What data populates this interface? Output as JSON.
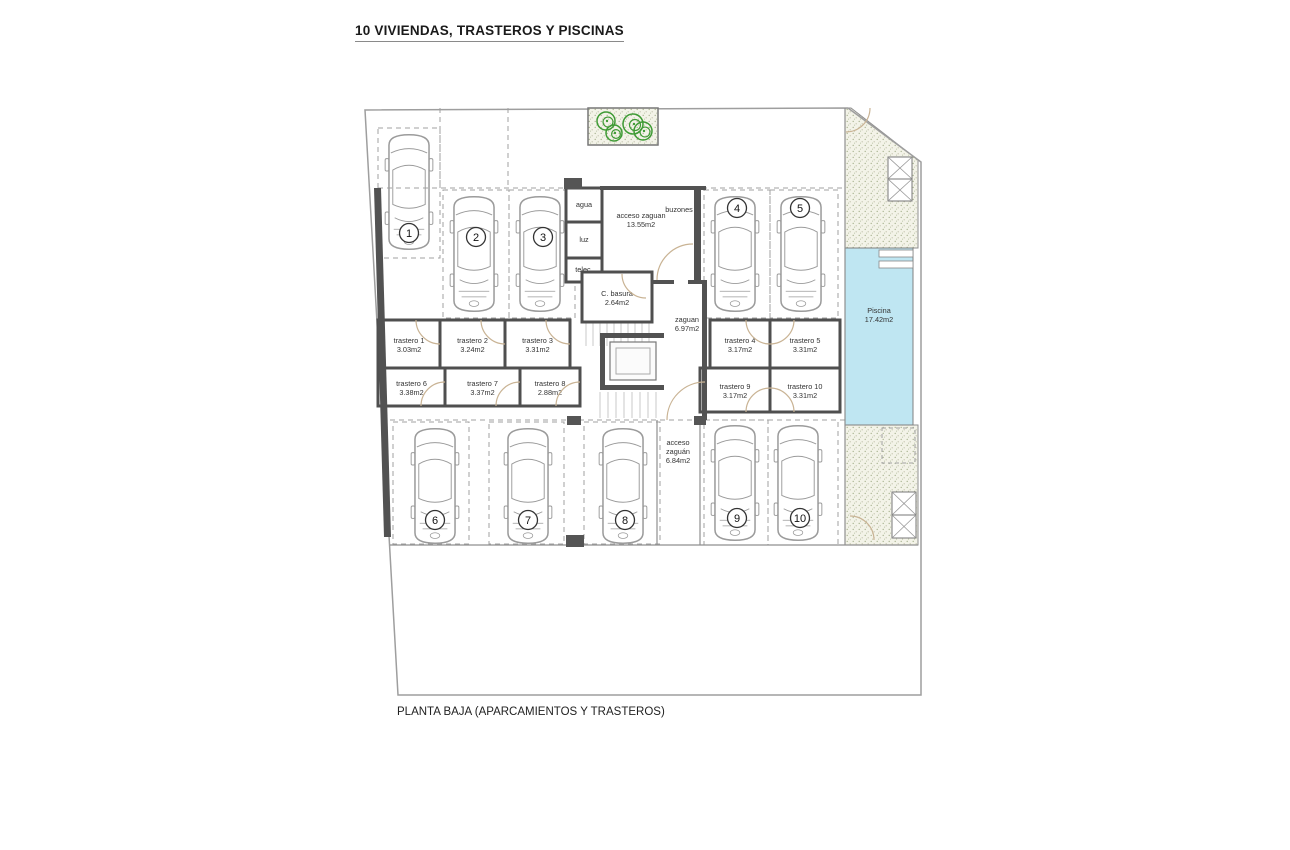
{
  "title": "10 VIVIENDAS, TRASTEROS Y PISCINAS",
  "caption": "PLANTA BAJA (APARCAMIENTOS Y TRASTEROS)",
  "colors": {
    "wall": "#525252",
    "room_stroke": "#4f4f4f",
    "thin": "#8f8f8f",
    "dash": "#a0a0a0",
    "pool": "#bfe6f2",
    "pool_stroke": "#808080",
    "stipple_bg": "#f3f3e8",
    "stipple_dot": "#a9b391",
    "tree": "#3f9b35",
    "door": "#c9b394",
    "car": "#9b9b9b",
    "stairs": "#c9c9c9",
    "boundary": "#9e9e9e"
  },
  "plan": {
    "plot_outline": "365,110 848,108 921,162 921,695 398,695",
    "stipple_upper": "845,108 851,108 918,160 918,248 845,248",
    "stipple_lower": [
      845,
      425,
      73,
      120
    ],
    "pool": {
      "x": 845,
      "y": 248,
      "w": 68,
      "h": 177,
      "label": "Piscina",
      "area": "17.42m2",
      "lx": 879,
      "ly": 313,
      "steps": [
        [
          879,
          250,
          34,
          7
        ],
        [
          879,
          261,
          34,
          7
        ]
      ]
    },
    "x_boxes": [
      [
        888,
        157,
        24,
        22
      ],
      [
        888,
        179,
        24,
        22
      ],
      [
        892,
        492,
        24,
        23
      ],
      [
        892,
        515,
        24,
        23
      ]
    ],
    "dashed_square": [
      882,
      428,
      33,
      35
    ],
    "left_wall": "374,188 381,188 391,537 384,537",
    "walls": [
      [
        600,
        186,
        106,
        4
      ],
      [
        694,
        190,
        7,
        90
      ],
      [
        702,
        282,
        5,
        138
      ],
      [
        652,
        280,
        22,
        4
      ],
      [
        688,
        280,
        19,
        4
      ]
    ],
    "thin_lines": [
      [
        845,
        108,
        845,
        545
      ],
      [
        390,
        545,
        918,
        545
      ],
      [
        657,
        420,
        657,
        545
      ],
      [
        700,
        420,
        700,
        545
      ]
    ],
    "dashed_lines": [
      [
        378,
        188,
        845,
        188
      ],
      [
        390,
        420,
        845,
        420
      ],
      [
        440,
        108,
        440,
        188
      ],
      [
        508,
        108,
        508,
        188
      ]
    ],
    "rooms": [
      {
        "name": "cuarto-agua",
        "label": "agua",
        "area": "",
        "x": 566,
        "y": 188,
        "w": 36,
        "h": 34
      },
      {
        "name": "cuarto-luz",
        "label": "luz",
        "area": "",
        "x": 566,
        "y": 222,
        "w": 36,
        "h": 36
      },
      {
        "name": "cuarto-telec",
        "label": "telec.",
        "area": "",
        "x": 566,
        "y": 258,
        "w": 36,
        "h": 24
      },
      {
        "name": "cuarto-basura",
        "label": "C. basura",
        "area": "2.64m2",
        "x": 582,
        "y": 272,
        "w": 70,
        "h": 50
      },
      {
        "name": "trastero-1",
        "label": "trastero 1",
        "area": "3.03m2",
        "x": 378,
        "y": 320,
        "w": 62,
        "h": 48
      },
      {
        "name": "trastero-2",
        "label": "trastero 2",
        "area": "3.24m2",
        "x": 440,
        "y": 320,
        "w": 65,
        "h": 48
      },
      {
        "name": "trastero-3",
        "label": "trastero 3",
        "area": "3.31m2",
        "x": 505,
        "y": 320,
        "w": 65,
        "h": 48
      },
      {
        "name": "trastero-4",
        "label": "trastero 4",
        "area": "3.17m2",
        "x": 710,
        "y": 320,
        "w": 60,
        "h": 48
      },
      {
        "name": "trastero-5",
        "label": "trastero 5",
        "area": "3.31m2",
        "x": 770,
        "y": 320,
        "w": 70,
        "h": 48
      },
      {
        "name": "trastero-6",
        "label": "trastero 6",
        "area": "3.38m2",
        "x": 378,
        "y": 368,
        "w": 67,
        "h": 38
      },
      {
        "name": "trastero-7",
        "label": "trastero 7",
        "area": "3.37m2",
        "x": 445,
        "y": 368,
        "w": 75,
        "h": 38
      },
      {
        "name": "trastero-8",
        "label": "trastero 8",
        "area": "2.88m2",
        "x": 520,
        "y": 368,
        "w": 60,
        "h": 38
      },
      {
        "name": "trastero-9",
        "label": "trastero 9",
        "area": "3.17m2",
        "x": 700,
        "y": 368,
        "w": 70,
        "h": 44
      },
      {
        "name": "trastero-10",
        "label": "trastero 10",
        "area": "3.31m2",
        "x": 770,
        "y": 368,
        "w": 70,
        "h": 44
      }
    ],
    "free_labels": [
      {
        "name": "buzones-label",
        "lines": [
          "buzones"
        ],
        "x": 679,
        "y": 212
      },
      {
        "name": "acceso-zaguan-label",
        "lines": [
          "acceso zaguan",
          "13.55m2"
        ],
        "x": 641,
        "y": 218
      },
      {
        "name": "zaguan-label",
        "lines": [
          "zaguan",
          "6.97m2"
        ],
        "x": 687,
        "y": 322
      },
      {
        "name": "acceso-zaguan-sur-label",
        "lines": [
          "acceso",
          "zaguán",
          "6.84m2"
        ],
        "x": 678,
        "y": 445
      },
      {
        "name": "piscina-label",
        "lines": [
          "Piscina",
          "17.42m2"
        ],
        "x": 879,
        "y": 313
      }
    ],
    "parking_spaces": [
      {
        "n": "1",
        "x": 378,
        "y": 128,
        "w": 62,
        "h": 130,
        "car_x": 380,
        "car_y": 130,
        "num_x": 409,
        "num_y": 233
      },
      {
        "n": "2",
        "x": 443,
        "y": 190,
        "w": 66,
        "h": 128,
        "car_x": 445,
        "car_y": 192,
        "num_x": 476,
        "num_y": 237
      },
      {
        "n": "3",
        "x": 509,
        "y": 190,
        "w": 66,
        "h": 128,
        "car_x": 511,
        "car_y": 192,
        "num_x": 543,
        "num_y": 237
      },
      {
        "n": "4",
        "x": 704,
        "y": 190,
        "w": 66,
        "h": 128,
        "car_x": 706,
        "car_y": 192,
        "num_x": 737,
        "num_y": 208
      },
      {
        "n": "5",
        "x": 770,
        "y": 190,
        "w": 68,
        "h": 128,
        "car_x": 772,
        "car_y": 192,
        "num_x": 800,
        "num_y": 208
      },
      {
        "n": "6",
        "x": 393,
        "y": 422,
        "w": 76,
        "h": 122,
        "car_x": 406,
        "car_y": 424,
        "num_x": 435,
        "num_y": 520
      },
      {
        "n": "7",
        "x": 489,
        "y": 422,
        "w": 75,
        "h": 122,
        "car_x": 499,
        "car_y": 424,
        "num_x": 528,
        "num_y": 520
      },
      {
        "n": "8",
        "x": 584,
        "y": 422,
        "w": 76,
        "h": 122,
        "car_x": 594,
        "car_y": 424,
        "num_x": 625,
        "num_y": 520
      },
      {
        "n": "9",
        "x": 704,
        "y": 420,
        "w": 64,
        "h": 125,
        "car_x": 706,
        "car_y": 421,
        "num_x": 737,
        "num_y": 518
      },
      {
        "n": "10",
        "x": 768,
        "y": 420,
        "w": 70,
        "h": 125,
        "car_x": 769,
        "car_y": 421,
        "num_x": 800,
        "num_y": 518
      }
    ],
    "door_arcs": [
      "M416,320 A24,24 0 0 0 440,344",
      "M481,320 A24,24 0 0 0 505,344",
      "M546,320 A24,24 0 0 0 570,344",
      "M746,320 A24,24 0 0 0 770,344",
      "M794,320 A24,24 0 0 1 770,344",
      "M421,406 A24,24 0 0 1 445,382",
      "M496,406 A24,24 0 0 1 520,382",
      "M556,406 A24,24 0 0 1 580,382",
      "M746,412 A24,24 0 0 1 770,388",
      "M770,388 A24,24 0 0 1 794,412",
      "M657,280 A36,36 0 0 1 693,244",
      "M622,274 A24,24 0 0 0 646,298",
      "M705,382 A38,38 0 0 0 667,420",
      "M846,132 A24,24 0 0 0 870,108",
      "M850,516 A24,24 0 0 1 874,540"
    ],
    "stairs": [
      {
        "x": 586,
        "y": 312,
        "w": 68,
        "h": 34,
        "step": 7
      },
      {
        "x": 600,
        "y": 392,
        "w": 62,
        "h": 26,
        "step": 8
      }
    ],
    "elevator": {
      "u": [
        [
          600,
          333,
          64,
          5
        ],
        [
          600,
          333,
          5,
          57
        ],
        [
          600,
          385,
          64,
          5
        ]
      ],
      "cab": [
        610,
        342,
        46,
        38
      ],
      "inner": [
        616,
        348,
        34,
        26
      ]
    },
    "planter": {
      "x": 588,
      "y": 108,
      "w": 70,
      "h": 37
    },
    "trees": [
      [
        606,
        121,
        9
      ],
      [
        633,
        124,
        10
      ],
      [
        614,
        133,
        8
      ],
      [
        643,
        131,
        9
      ]
    ],
    "pillars": [
      [
        564,
        178,
        18,
        11
      ],
      [
        567,
        416,
        14,
        9
      ],
      [
        566,
        535,
        18,
        12
      ],
      [
        694,
        416,
        12,
        9
      ]
    ]
  }
}
